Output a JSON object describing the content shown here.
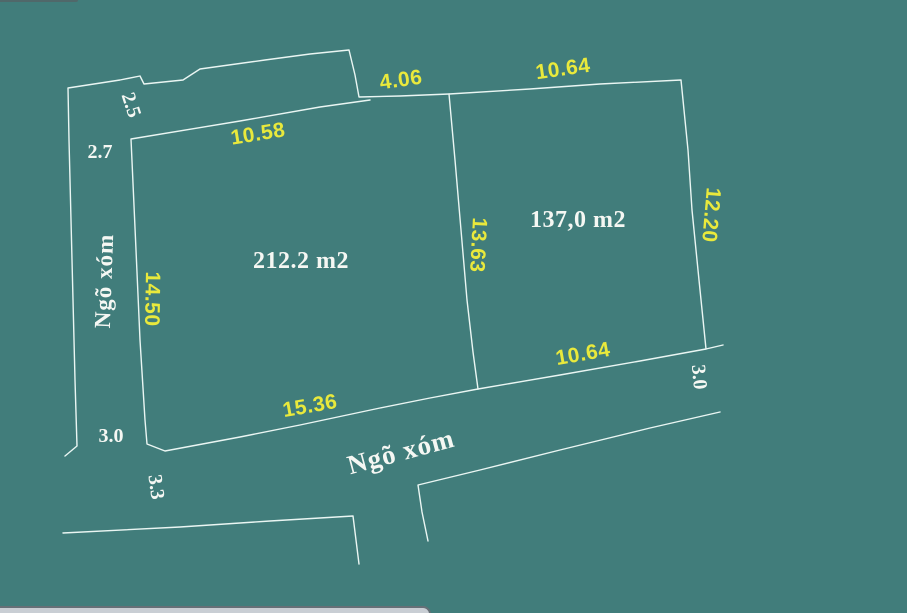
{
  "diagram": {
    "title": "Land plot sketch (cadastral dimension drawing)",
    "colors": {
      "background": "#417d7b",
      "boundary_line": "#eaf6f3",
      "dimension_text": "#e9e93c",
      "white_text": "#f5f7f3",
      "bottom_bar_fill": "#c9ced4",
      "bottom_bar_outline": "#667077"
    },
    "parcels": [
      {
        "area_label": "212.2 m2",
        "edge_dimensions": {
          "top": "10.58",
          "top_right": "4.06",
          "left": "14.50",
          "bottom": "15.36",
          "right_shared": "13.63"
        }
      },
      {
        "area_label": "137,0 m2",
        "edge_dimensions": {
          "top": "10.64",
          "right": "12.20",
          "bottom": "10.64",
          "left_shared": "13.63"
        }
      }
    ],
    "roads": [
      {
        "name": "Ngõ xóm",
        "position": "left"
      },
      {
        "name": "Ngõ xóm",
        "position": "bottom"
      }
    ],
    "offset_measurements": [
      "2.5",
      "2.7",
      "3.0",
      "3.3",
      "3.0"
    ],
    "labels": [
      {
        "text": "10.58",
        "kind": "dim",
        "x": 258,
        "y": 134,
        "rot": -9
      },
      {
        "text": "4.06",
        "kind": "dim",
        "x": 401,
        "y": 80,
        "rot": -8
      },
      {
        "text": "10.64",
        "kind": "dim",
        "x": 563,
        "y": 69,
        "rot": -8
      },
      {
        "text": "14.50",
        "kind": "dim",
        "x": 152,
        "y": 299,
        "rot": 91
      },
      {
        "text": "13.63",
        "kind": "dim",
        "x": 478,
        "y": 245,
        "rot": 93
      },
      {
        "text": "12.20",
        "kind": "dim",
        "x": 711,
        "y": 215,
        "rot": 95
      },
      {
        "text": "15.36",
        "kind": "dim",
        "x": 310,
        "y": 406,
        "rot": -10
      },
      {
        "text": "10.64",
        "kind": "dim",
        "x": 583,
        "y": 354,
        "rot": -10
      },
      {
        "text": "2.5",
        "kind": "offset",
        "x": 131,
        "y": 105,
        "rot": 72
      },
      {
        "text": "2.7",
        "kind": "offset",
        "x": 100,
        "y": 152,
        "rot": 0
      },
      {
        "text": "3.0",
        "kind": "offset",
        "x": 111,
        "y": 436,
        "rot": 0
      },
      {
        "text": "3.3",
        "kind": "offset",
        "x": 156,
        "y": 487,
        "rot": 82
      },
      {
        "text": "3.0",
        "kind": "offset",
        "x": 699,
        "y": 377,
        "rot": 85
      },
      {
        "text": "212.2 m2",
        "kind": "area",
        "x": 301,
        "y": 261,
        "rot": 0
      },
      {
        "text": "137,0 m2",
        "kind": "area",
        "x": 578,
        "y": 220,
        "rot": 0
      },
      {
        "text": "Ngõ xóm",
        "kind": "road left",
        "x": 104,
        "y": 281,
        "rot": -88
      },
      {
        "text": "Ngõ xóm",
        "kind": "road bottom",
        "x": 401,
        "y": 452,
        "rot": -15
      }
    ]
  }
}
